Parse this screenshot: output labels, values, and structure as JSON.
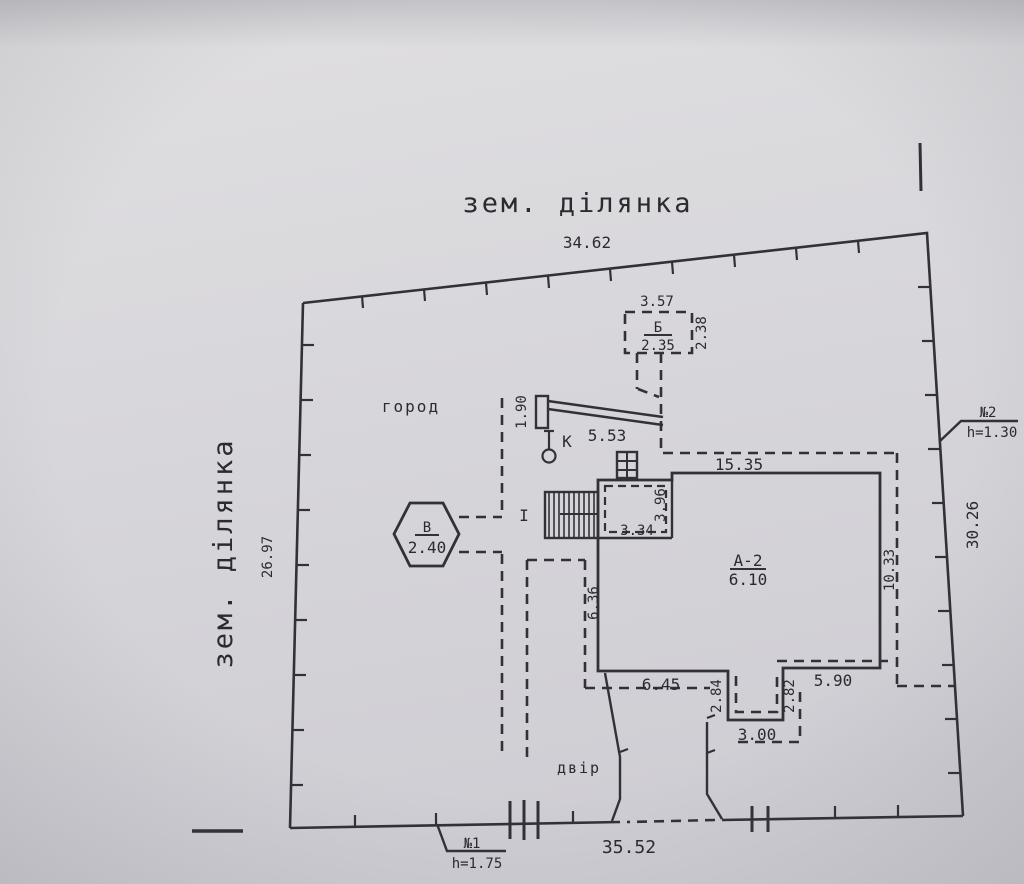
{
  "plot": {
    "label_top": "зем. ділянка",
    "label_left": "зем. ділянка",
    "dim_top": "34.62",
    "dim_left": "26.97",
    "dim_right": "30.26",
    "dim_bottom": "35.52"
  },
  "markers": {
    "no1": {
      "label": "№1",
      "height": "h=1.75"
    },
    "no2": {
      "label": "№2",
      "height": "h=1.30"
    }
  },
  "areas": {
    "garden": "город",
    "yard": "двір"
  },
  "main_building": {
    "label": "А-2",
    "value": "6.10",
    "dim_top": "15.35",
    "dim_right": "10.33",
    "dim_left": "6.36",
    "dim_section_width": "3.34",
    "dim_section_height": "3.96",
    "dim_bottom_left": "6.45",
    "dim_notch_left": "2.84",
    "dim_notch_bottom": "3.00",
    "dim_notch_right": "2.82",
    "dim_bottom_right": "5.90"
  },
  "outbuilding_b": {
    "label": "Б",
    "value": "2.35",
    "dim_top": "3.57",
    "dim_right": "2.38"
  },
  "structure_v": {
    "label": "В",
    "value": "2.40"
  },
  "fence": {
    "dim_length": "5.53",
    "dim_width": "1.90",
    "well_label": "К"
  },
  "porch_label": "I",
  "colors": {
    "ink": "#323137",
    "paper": "#d8d7db"
  }
}
